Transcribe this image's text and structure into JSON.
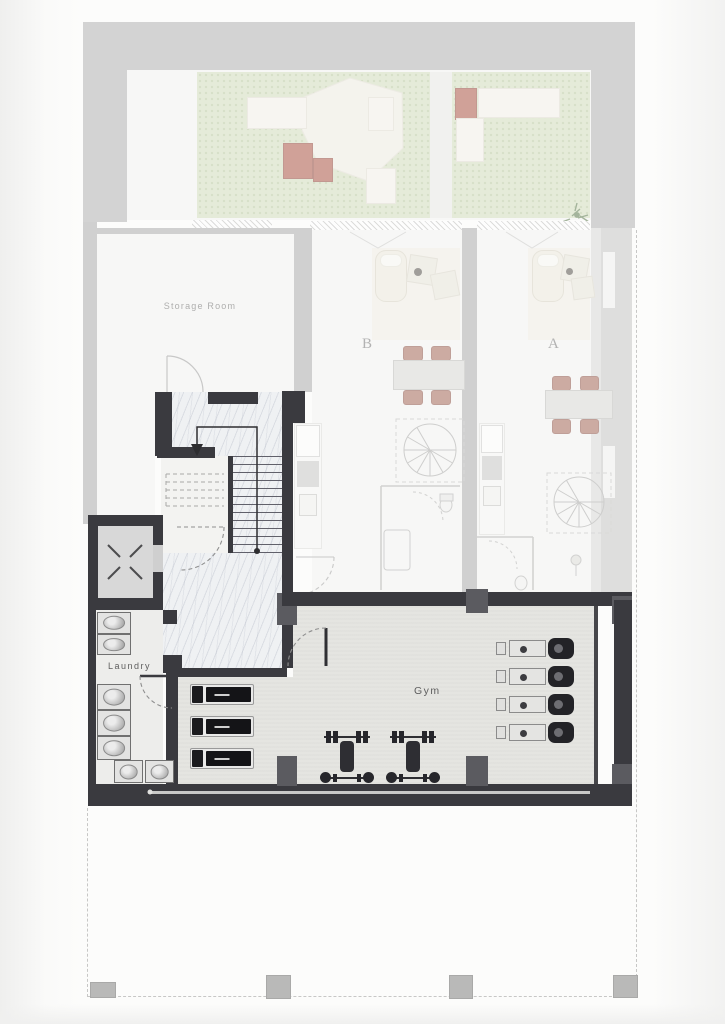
{
  "labels": {
    "storage_room": "Storage Room",
    "unit_b": "B",
    "unit_a": "A",
    "laundry": "Laundry",
    "gym": "Gym"
  },
  "equipment": {
    "washing_machines": 7,
    "treadmills": 3,
    "exercise_bikes": 4,
    "weight_benches": 2,
    "elevators": 1,
    "main_staircases": 1,
    "spiral_staircases": 2
  },
  "colors": {
    "active_wall": "#3a3a3f",
    "column": "#5b5b60",
    "faded_wall": "#adadad",
    "garden_green": "#d3debe",
    "marble_floor": "#eff1f3",
    "gym_floor": "#e5e5e1",
    "chair_accent": "#a5695b",
    "planter_red": "#ad5849",
    "boundary_dash": "#c7c7c6"
  }
}
